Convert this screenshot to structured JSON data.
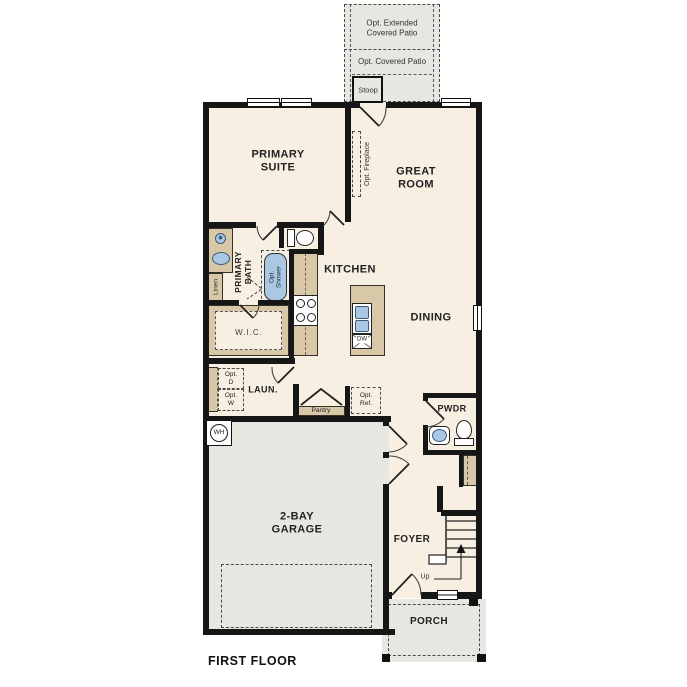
{
  "title": "FIRST FLOOR",
  "colors": {
    "floor": "#f7efe1",
    "concrete": "#e7e6e1",
    "cabinet": "#d8c8a8",
    "fixture": "#aac8e4",
    "wall": "#161616",
    "ink": "#222222"
  },
  "rooms": {
    "primary_suite": "PRIMARY\nSUITE",
    "great_room": "GREAT\nROOM",
    "kitchen": "KITCHEN",
    "dining": "DINING",
    "primary_bath": "PRIMARY\nBATH",
    "wic": "W.I.C.",
    "laundry": "LAUN.",
    "pwdr": "PWDR",
    "garage": "2-BAY\nGARAGE",
    "foyer": "FOYER",
    "porch": "PORCH"
  },
  "features": {
    "ext_patio": "Opt. Extended\nCovered Patio",
    "cov_patio": "Opt. Covered Patio",
    "stoop": "Stoop",
    "opt_fireplace": "Opt. Fireplace",
    "opt_shower": "Opt.\nShower",
    "linen": "Linen",
    "pantry": "Pantry",
    "opt_ref": "Opt.\nRef.",
    "opt_dryer": "Opt.\nD",
    "opt_washer": "Opt.\nW",
    "water_heater": "WH",
    "dishwasher": "DW",
    "up": "Up"
  }
}
